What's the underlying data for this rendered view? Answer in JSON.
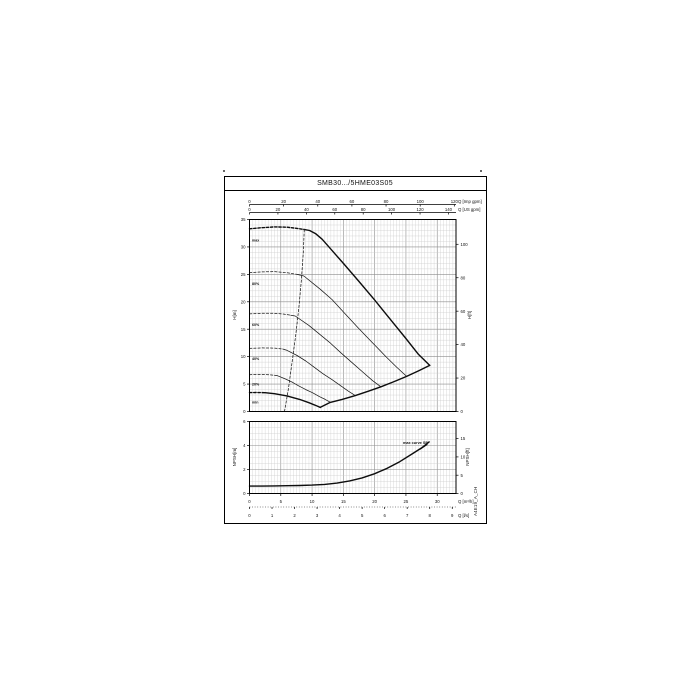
{
  "page": {
    "title": "SMB30.../5HME03S05",
    "side_code": "A4E19_A_CH"
  },
  "colors": {
    "ink": "#111111",
    "grid_minor": "#c9c9c9",
    "grid_major": "#8d8d8d",
    "paper": "#ffffff"
  },
  "chart_data": [
    {
      "id": "head-capacity",
      "type": "line",
      "title": "SMB30.../5HME03S05",
      "x_range_m3h": [
        0,
        33
      ],
      "grid": "fine-on",
      "axes": {
        "top_imp": {
          "label": "Q [Imp gpm]",
          "ticks": [
            0,
            20,
            40,
            60,
            80,
            100,
            120
          ],
          "to_m3h": 0.27276
        },
        "top_us": {
          "label": "Q [US gpm]",
          "ticks": [
            0,
            20,
            40,
            60,
            80,
            100,
            120,
            140
          ],
          "to_m3h": 0.22712
        },
        "left": {
          "label": "H[m]",
          "ticks": [
            0,
            5,
            10,
            15,
            20,
            25,
            30,
            35
          ],
          "max": 35
        },
        "right": {
          "label": "H[ft]",
          "ticks": [
            0,
            20,
            40,
            60,
            80,
            100
          ],
          "to_m": 0.3048
        }
      },
      "series": [
        {
          "name": "max",
          "label": "max",
          "weight": "bold",
          "label_at": [
            0.4,
            31.6
          ],
          "dashed_points": [
            [
              0,
              33.3
            ],
            [
              2,
              33.5
            ],
            [
              4,
              33.65
            ],
            [
              6,
              33.6
            ],
            [
              7.5,
              33.4
            ],
            [
              8.7,
              33.2
            ]
          ],
          "solid_points": [
            [
              8.7,
              33.2
            ],
            [
              9.6,
              33.0
            ],
            [
              10.6,
              32.4
            ],
            [
              11.6,
              31.4
            ],
            [
              13,
              29.6
            ],
            [
              15,
              27.0
            ],
            [
              17.5,
              23.7
            ],
            [
              20,
              20.3
            ],
            [
              22.5,
              16.8
            ],
            [
              25,
              13.3
            ],
            [
              27,
              10.4
            ],
            [
              28.8,
              8.4
            ]
          ]
        },
        {
          "name": "speed-80",
          "label": "80%",
          "weight": "thin",
          "label_at": [
            0.4,
            23.6
          ],
          "dashed_points": [
            [
              0,
              25.3
            ],
            [
              2,
              25.45
            ],
            [
              4,
              25.5
            ],
            [
              6,
              25.3
            ],
            [
              7.6,
              25.0
            ]
          ],
          "solid_points": [
            [
              7.6,
              25.0
            ],
            [
              8.7,
              24.7
            ],
            [
              11.3,
              22.3
            ],
            [
              13.2,
              20.4
            ],
            [
              15.2,
              17.9
            ],
            [
              17.4,
              15.2
            ],
            [
              19.6,
              12.6
            ],
            [
              21.8,
              10.0
            ],
            [
              23.5,
              8.1
            ],
            [
              25.1,
              6.4
            ]
          ]
        },
        {
          "name": "speed-60",
          "label": "60%",
          "weight": "thin",
          "label_at": [
            0.4,
            16.2
          ],
          "dashed_points": [
            [
              0,
              17.8
            ],
            [
              2,
              17.9
            ],
            [
              4,
              17.9
            ],
            [
              5.5,
              17.75
            ],
            [
              6.6,
              17.55
            ]
          ],
          "solid_points": [
            [
              6.6,
              17.55
            ],
            [
              7.3,
              17.4
            ],
            [
              9.5,
              15.7
            ],
            [
              11.2,
              14.1
            ],
            [
              12.8,
              12.6
            ],
            [
              14.6,
              10.7
            ],
            [
              16.4,
              8.9
            ],
            [
              18.3,
              7.0
            ],
            [
              19.7,
              5.6
            ],
            [
              21.0,
              4.5
            ]
          ]
        },
        {
          "name": "speed-40",
          "label": "40%",
          "weight": "thin",
          "label_at": [
            0.4,
            10.0
          ],
          "dashed_points": [
            [
              0,
              11.5
            ],
            [
              2,
              11.6
            ],
            [
              4,
              11.55
            ],
            [
              5.3,
              11.4
            ]
          ],
          "solid_points": [
            [
              5.3,
              11.4
            ],
            [
              5.9,
              11.2
            ],
            [
              7.6,
              10.2
            ],
            [
              9.0,
              9.2
            ],
            [
              10.3,
              8.1
            ],
            [
              11.7,
              6.9
            ],
            [
              13.2,
              5.8
            ],
            [
              14.7,
              4.6
            ],
            [
              15.8,
              3.7
            ],
            [
              16.9,
              2.9
            ]
          ]
        },
        {
          "name": "speed-20",
          "label": "20%",
          "weight": "thin",
          "label_at": [
            0.4,
            5.3
          ],
          "dashed_points": [
            [
              0,
              6.7
            ],
            [
              1.5,
              6.75
            ],
            [
              3,
              6.7
            ],
            [
              4.0,
              6.6
            ]
          ],
          "solid_points": [
            [
              4.0,
              6.6
            ],
            [
              4.5,
              6.5
            ],
            [
              5.8,
              5.9
            ],
            [
              6.9,
              5.3
            ],
            [
              7.8,
              4.7
            ],
            [
              9.0,
              4.0
            ],
            [
              10.1,
              3.4
            ],
            [
              11.2,
              2.7
            ],
            [
              12.1,
              2.2
            ],
            [
              12.9,
              1.7
            ]
          ]
        },
        {
          "name": "min",
          "label": "min",
          "weight": "bold",
          "label_at": [
            0.4,
            2.0
          ],
          "dashed_points": [
            [
              0,
              3.45
            ],
            [
              1.2,
              3.47
            ],
            [
              2.5,
              3.42
            ]
          ],
          "solid_points": [
            [
              2.5,
              3.42
            ],
            [
              4,
              3.25
            ],
            [
              6,
              2.85
            ],
            [
              8,
              2.2
            ],
            [
              9.5,
              1.6
            ],
            [
              10.8,
              1.0
            ],
            [
              11.3,
              0.75
            ]
          ]
        },
        {
          "name": "min-flow-limit",
          "label": "",
          "weight": "thin",
          "dashed_points": [
            [
              5.6,
              0
            ],
            [
              6.2,
              4
            ],
            [
              6.8,
              9
            ],
            [
              7.4,
              14
            ],
            [
              7.9,
              19
            ],
            [
              8.3,
              24
            ],
            [
              8.6,
              29
            ],
            [
              8.75,
              33.3
            ]
          ],
          "solid_points": []
        },
        {
          "name": "end-of-curve-envelope",
          "label": "",
          "weight": "bold",
          "dashed_points": [],
          "solid_points": [
            [
              11.3,
              0.75
            ],
            [
              12.9,
              1.66
            ],
            [
              14.8,
              2.2
            ],
            [
              16.9,
              2.9
            ],
            [
              19.0,
              3.7
            ],
            [
              21.0,
              4.5
            ],
            [
              23.0,
              5.4
            ],
            [
              25.1,
              6.4
            ],
            [
              27.0,
              7.4
            ],
            [
              28.8,
              8.4
            ]
          ]
        }
      ]
    },
    {
      "id": "npsh",
      "type": "line",
      "x_range_m3h": [
        0,
        33
      ],
      "grid": "fine-on",
      "axes": {
        "left": {
          "label": "NPSH[m]",
          "ticks": [
            0,
            2,
            4,
            6
          ],
          "max": 6
        },
        "right": {
          "label": "NPSH[ft]",
          "ticks": [
            0,
            5,
            10,
            15
          ],
          "to_m": 0.3048
        },
        "bottom_m3h": {
          "label": "Q [m³/h]",
          "ticks": [
            0,
            5,
            10,
            15,
            20,
            25,
            30
          ]
        },
        "bottom_ls": {
          "label": "Q [l/s]",
          "ticks": [
            0,
            1,
            2,
            3,
            4,
            5,
            6,
            7,
            8,
            9
          ],
          "to_m3h": 3.6
        }
      },
      "annotation": "max curve SP",
      "series": [
        {
          "name": "npsh-max-curve",
          "weight": "bold",
          "points": [
            [
              0,
              0.62
            ],
            [
              2,
              0.62
            ],
            [
              4,
              0.63
            ],
            [
              6,
              0.65
            ],
            [
              8,
              0.67
            ],
            [
              10,
              0.7
            ],
            [
              12,
              0.76
            ],
            [
              14,
              0.87
            ],
            [
              16,
              1.05
            ],
            [
              18,
              1.3
            ],
            [
              20,
              1.65
            ],
            [
              22,
              2.1
            ],
            [
              24,
              2.65
            ],
            [
              26,
              3.3
            ],
            [
              27.5,
              3.8
            ],
            [
              28.7,
              4.3
            ]
          ]
        }
      ]
    }
  ]
}
